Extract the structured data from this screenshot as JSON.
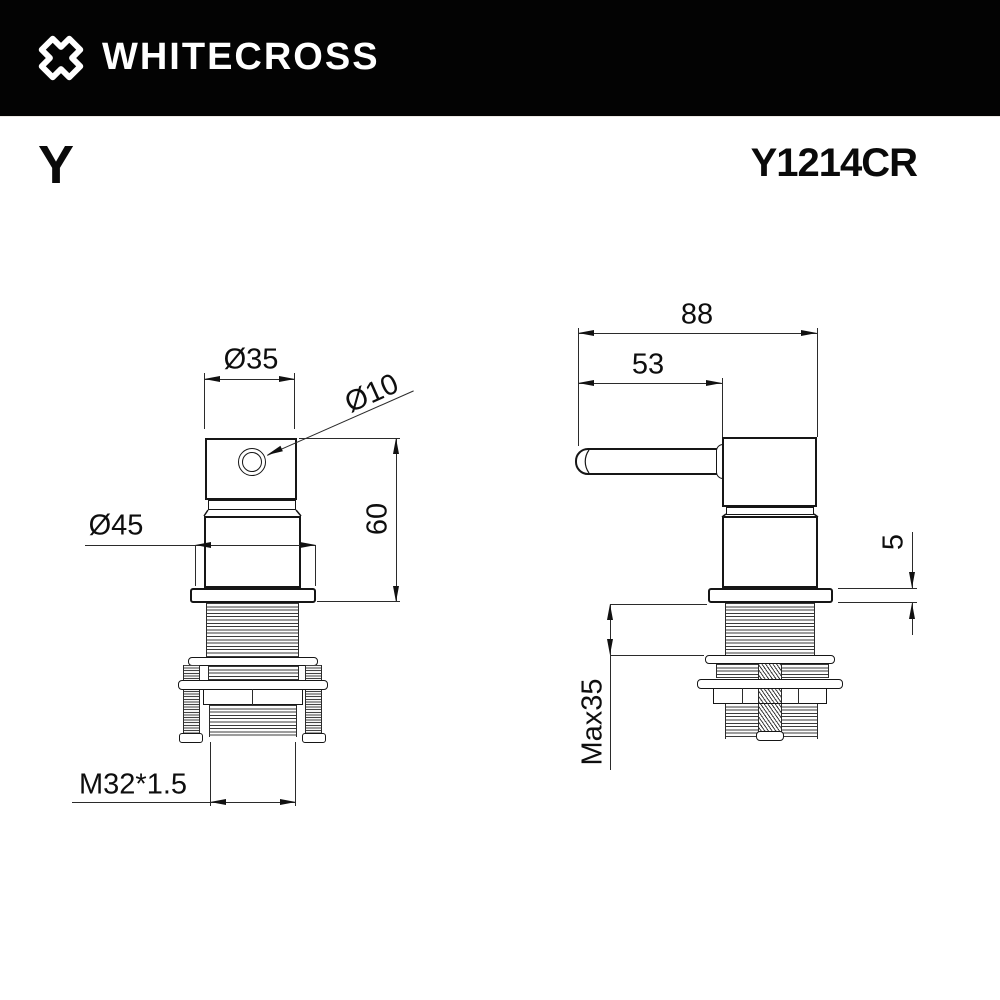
{
  "header": {
    "brand": "WHITECROSS"
  },
  "product": {
    "series": "Y",
    "code": "Y1214CR"
  },
  "front_view": {
    "dim_top_diameter": "Ø35",
    "dim_hole_diameter": "Ø10",
    "dim_flange_diameter": "Ø45",
    "dim_height": "60",
    "dim_thread": "M32*1.5"
  },
  "side_view": {
    "dim_total_depth": "88",
    "dim_handle_length": "53",
    "dim_flange_thickness": "5",
    "dim_max_mounting": "Max35"
  },
  "colors": {
    "header_bg": "#030303",
    "header_text": "#ffffff",
    "line": "#1a1a1a",
    "background": "#ffffff"
  }
}
